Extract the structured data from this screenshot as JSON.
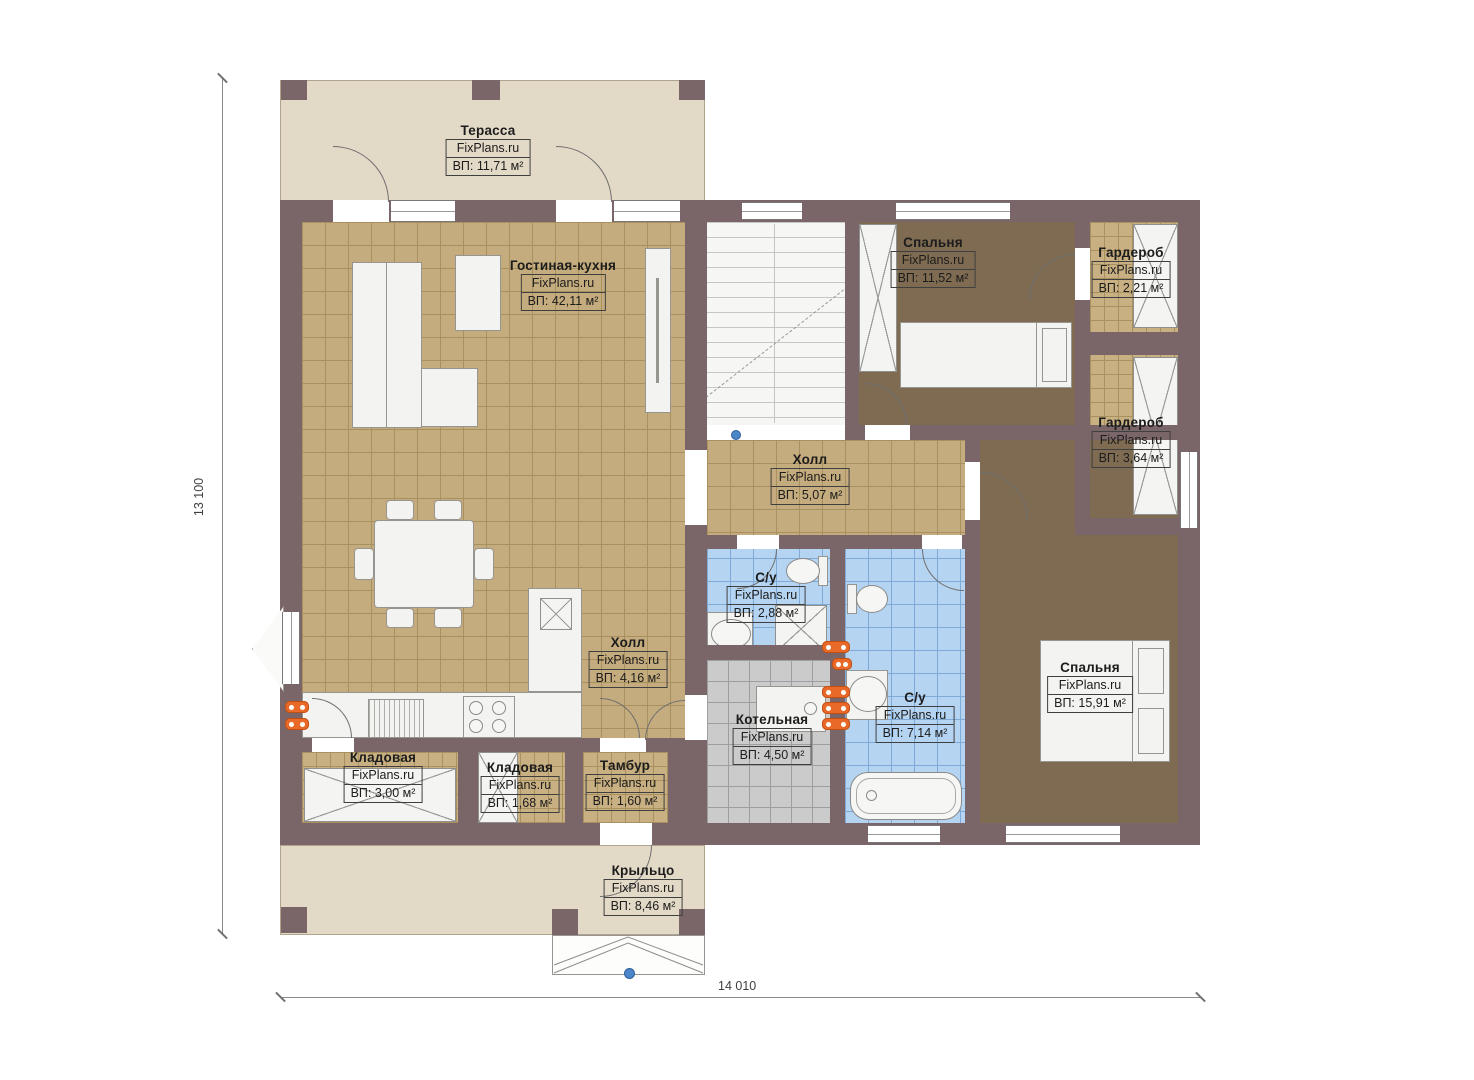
{
  "site_watermark": "FixPlans.ru",
  "dimensions": {
    "vertical": "13 100",
    "horizontal": "14 010"
  },
  "colors": {
    "wall": "#7a6568",
    "floor_tan": "#c5ac7e",
    "floor_blue": "#b5d4f1",
    "floor_gray": "#cbcbcb",
    "carpet_brown": "#7e6b51",
    "deck_beige": "#e3d9c7",
    "radiator_orange": "#e96a28"
  },
  "rooms": [
    {
      "id": "terrace",
      "name": "Терасса",
      "site": "FixPlans.ru",
      "area": "ВП: 11,71 м²"
    },
    {
      "id": "living",
      "name": "Гостиная-кухня",
      "site": "FixPlans.ru",
      "area": "ВП: 42,11 м²"
    },
    {
      "id": "bedroom-1",
      "name": "Спальня",
      "site": "FixPlans.ru",
      "area": "ВП: 11,52 м²"
    },
    {
      "id": "wardrobe-1",
      "name": "Гардероб",
      "site": "FixPlans.ru",
      "area": "ВП: 2,21 м²"
    },
    {
      "id": "wardrobe-2",
      "name": "Гардероб",
      "site": "FixPlans.ru",
      "area": "ВП: 3,64 м²"
    },
    {
      "id": "hall-1",
      "name": "Холл",
      "site": "FixPlans.ru",
      "area": "ВП: 5,07 м²"
    },
    {
      "id": "bath-1",
      "name": "С/у",
      "site": "FixPlans.ru",
      "area": "ВП: 2,88 м²"
    },
    {
      "id": "bath-2",
      "name": "С/у",
      "site": "FixPlans.ru",
      "area": "ВП: 7,14 м²"
    },
    {
      "id": "bedroom-2",
      "name": "Спальня",
      "site": "FixPlans.ru",
      "area": "ВП: 15,91 м²"
    },
    {
      "id": "boiler",
      "name": "Котельная",
      "site": "FixPlans.ru",
      "area": "ВП: 4,50 м²"
    },
    {
      "id": "hall-2",
      "name": "Холл",
      "site": "FixPlans.ru",
      "area": "ВП: 4,16 м²"
    },
    {
      "id": "storage-1",
      "name": "Кладовая",
      "site": "FixPlans.ru",
      "area": "ВП: 3,00 м²"
    },
    {
      "id": "storage-2",
      "name": "Кладовая",
      "site": "FixPlans.ru",
      "area": "ВП: 1,68 м²"
    },
    {
      "id": "vestibule",
      "name": "Тамбур",
      "site": "FixPlans.ru",
      "area": "ВП: 1,60 м²"
    },
    {
      "id": "porch",
      "name": "Крыльцо",
      "site": "FixPlans.ru",
      "area": "ВП: 8,46 м²"
    }
  ]
}
